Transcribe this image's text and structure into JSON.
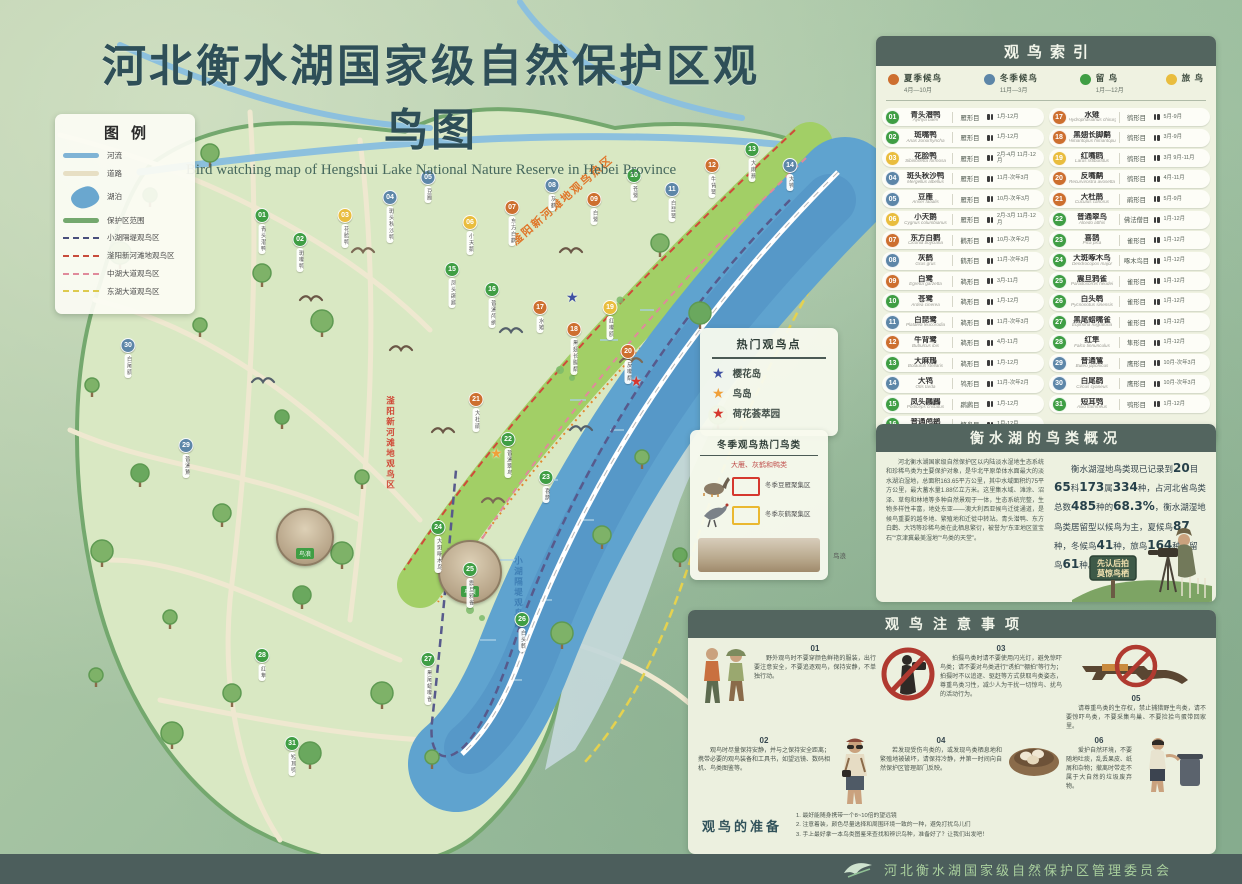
{
  "title": {
    "cn": "河北衡水湖国家级自然保护区观鸟图",
    "en": "Bird watching map of Hengshui Lake National Nature Reserve in Hebei Province"
  },
  "legend": {
    "title": "图例",
    "items": [
      {
        "label": "河流",
        "type": "line",
        "color": "#7fb3d5"
      },
      {
        "label": "道路",
        "type": "line",
        "color": "#e7dfc4"
      },
      {
        "label": "湖泊",
        "type": "blob",
        "color": "#6aa7cf"
      },
      {
        "label": "保护区范围",
        "type": "line",
        "color": "#74a86e"
      },
      {
        "label": "小湖隔堤观鸟区",
        "type": "dash",
        "color": "#4a4f7c"
      },
      {
        "label": "滏阳新河滩地观鸟区",
        "type": "dash",
        "color": "#c84b3c"
      },
      {
        "label": "中湖大道观鸟区",
        "type": "dash",
        "color": "#e08a9b"
      },
      {
        "label": "东湖大道观鸟区",
        "type": "dash",
        "color": "#ddca4e"
      }
    ]
  },
  "map": {
    "hot_zone_label": "滏阳新河滩地观鸟热区",
    "strip_label": "滏阳新河滩地观鸟区",
    "dike_label": "小湖隔堤观鸟区",
    "bird_wave_label": "鸟浪"
  },
  "hotspots": {
    "title": "热门观鸟点",
    "items": [
      {
        "label": "樱花岛",
        "color": "#3f51a3"
      },
      {
        "label": "鸟岛",
        "color": "#f0a03a"
      },
      {
        "label": "荷花荟萃园",
        "color": "#d5382e"
      }
    ]
  },
  "winter": {
    "title": "冬季观鸟热门鸟类",
    "subtitle": "大雁、灰鹤和鸭类",
    "zones": [
      {
        "icon": "goose",
        "swatch": "#d5382e",
        "label": "冬季豆雁聚集区"
      },
      {
        "icon": "crane",
        "swatch": "#eab830",
        "label": "冬季灰鹤聚集区"
      }
    ],
    "photo_label": "鸟浪"
  },
  "index": {
    "title": "观鸟索引",
    "seasons": [
      {
        "key": "summer",
        "label": "夏季候鸟",
        "months": "4月—10月",
        "color": "#cd6f2f"
      },
      {
        "key": "winter",
        "label": "冬季候鸟",
        "months": "11月—3月",
        "color": "#5d86a8"
      },
      {
        "key": "resident",
        "label": "留  鸟",
        "months": "1月—12月",
        "color": "#3f9e44"
      },
      {
        "key": "passage",
        "label": "旅  鸟",
        "months": "",
        "color": "#e9bd3e"
      }
    ],
    "items": [
      {
        "num": "01",
        "name": "青头潜鸭",
        "latin": "Aythya baeri",
        "order": "雁形目",
        "months": "1月-12月",
        "season": "resident"
      },
      {
        "num": "02",
        "name": "斑嘴鸭",
        "latin": "Anas zonorhyncha",
        "order": "雁形目",
        "months": "1月-12月",
        "season": "resident"
      },
      {
        "num": "03",
        "name": "花脸鸭",
        "latin": "Sibirionetta formosa",
        "order": "雁形目",
        "months": "2月-4月 11月-12月",
        "season": "passage"
      },
      {
        "num": "04",
        "name": "斑头秋沙鸭",
        "latin": "Mergellus albellus",
        "order": "雁形目",
        "months": "11月-次年3月",
        "season": "winter"
      },
      {
        "num": "05",
        "name": "豆雁",
        "latin": "Anser fabalis",
        "order": "雁形目",
        "months": "10月-次年3月",
        "season": "winter"
      },
      {
        "num": "06",
        "name": "小天鹅",
        "latin": "Cygnus columbianus",
        "order": "雁形目",
        "months": "2月-3月 11月-12月",
        "season": "passage"
      },
      {
        "num": "07",
        "name": "东方白鹳",
        "latin": "Ciconia boyciana",
        "order": "鹳形目",
        "months": "10月-次年2月",
        "season": "summer"
      },
      {
        "num": "08",
        "name": "灰鹤",
        "latin": "Grus grus",
        "order": "鹤形目",
        "months": "11月-次年3月",
        "season": "winter"
      },
      {
        "num": "09",
        "name": "白鹭",
        "latin": "Egretta garzetta",
        "order": "鹈形目",
        "months": "3月-11月",
        "season": "summer"
      },
      {
        "num": "10",
        "name": "苍鹭",
        "latin": "Ardea cinerea",
        "order": "鹈形目",
        "months": "1月-12月",
        "season": "resident"
      },
      {
        "num": "11",
        "name": "白琵鹭",
        "latin": "Platalea leucorodia",
        "order": "鹈形目",
        "months": "11月-次年3月",
        "season": "winter"
      },
      {
        "num": "12",
        "name": "牛背鹭",
        "latin": "Bubulcus ibis",
        "order": "鹈形目",
        "months": "4月-11月",
        "season": "summer"
      },
      {
        "num": "13",
        "name": "大麻鳽",
        "latin": "Botaurus stellaris",
        "order": "鹈形目",
        "months": "1月-12月",
        "season": "resident"
      },
      {
        "num": "14",
        "name": "大鸨",
        "latin": "Otis tarda",
        "order": "鸨形目",
        "months": "11月-次年2月",
        "season": "winter"
      },
      {
        "num": "15",
        "name": "凤头鸊鷉",
        "latin": "Podiceps cristatus",
        "order": "䴙䴘目",
        "months": "1月-12月",
        "season": "resident"
      },
      {
        "num": "16",
        "name": "普通鸬鹚",
        "latin": "Phalacrocorax carbo",
        "order": "鲣鸟目",
        "months": "1月-12月",
        "season": "resident"
      },
      {
        "num": "17",
        "name": "水雉",
        "latin": "Hydrophasianus chirurgus",
        "order": "鸻形目",
        "months": "5月-9月",
        "season": "summer"
      },
      {
        "num": "18",
        "name": "黑翅长脚鹬",
        "latin": "Himantopus himantopus",
        "order": "鸻形目",
        "months": "3月-9月",
        "season": "summer"
      },
      {
        "num": "19",
        "name": "红嘴鸥",
        "latin": "Larus ridibundus",
        "order": "鸻形目",
        "months": "3月 9月-11月",
        "season": "passage"
      },
      {
        "num": "20",
        "name": "反嘴鹬",
        "latin": "Recurvirostra avosetta",
        "order": "鸻形目",
        "months": "4月-11月",
        "season": "summer"
      },
      {
        "num": "21",
        "name": "大杜鹃",
        "latin": "Cuculus canorus",
        "order": "鹃形目",
        "months": "5月-9月",
        "season": "summer"
      },
      {
        "num": "22",
        "name": "普通翠鸟",
        "latin": "Alcedo atthis",
        "order": "佛法僧目",
        "months": "1月-12月",
        "season": "resident"
      },
      {
        "num": "23",
        "name": "喜鹊",
        "latin": "Pica pica",
        "order": "雀形目",
        "months": "1月-12月",
        "season": "resident"
      },
      {
        "num": "24",
        "name": "大斑啄木鸟",
        "latin": "Dendrocopos major",
        "order": "啄木鸟目",
        "months": "1月-12月",
        "season": "resident"
      },
      {
        "num": "25",
        "name": "震旦鸦雀",
        "latin": "Paradoxornis heudei",
        "order": "雀形目",
        "months": "1月-12月",
        "season": "resident"
      },
      {
        "num": "26",
        "name": "白头鹎",
        "latin": "Pycnonotus sinensis",
        "order": "雀形目",
        "months": "1月-12月",
        "season": "resident"
      },
      {
        "num": "27",
        "name": "黑尾蜡嘴雀",
        "latin": "Eophona migratoria",
        "order": "雀形目",
        "months": "1月-12月",
        "season": "resident"
      },
      {
        "num": "28",
        "name": "红隼",
        "latin": "Falco tinnunculus",
        "order": "隼形目",
        "months": "1月-12月",
        "season": "resident"
      },
      {
        "num": "29",
        "name": "普通鵟",
        "latin": "Buteo japonicus",
        "order": "鹰形目",
        "months": "10月-次年3月",
        "season": "winter"
      },
      {
        "num": "30",
        "name": "白尾鹞",
        "latin": "Circus cyaneus",
        "order": "鹰形目",
        "months": "10月-次年3月",
        "season": "winter"
      },
      {
        "num": "31",
        "name": "短耳鸮",
        "latin": "Asio flammeus",
        "order": "鸮形目",
        "months": "1月-12月",
        "season": "resident"
      }
    ]
  },
  "overview": {
    "title": "衡水湖的鸟类概况",
    "paragraph_left": "河北衡水湖国家级自然保护区以内陆淡水湿地生态系统和珍稀鸟类为主要保护对象，是华北平原单体水面最大的淡水湖泊湿地，总面积163.65平方公里，其中水域面积约75平方公里，最大蓄水量1.88亿立方米。这里集水域、滩涂、沼泽、草甸和林地等多种自然景观于一体，生态系统完整，生物多样性丰富，地处东亚——澳大利西亚候鸟迁徙通道，是候鸟重要的越冬地、繁殖地和迁徙中转站。青头潜鸭、东方白鹳、大鸨等珍稀鸟类在此栖息繁衍，被誉为“东亚地区蓝宝石”“京津冀最美湿地”“鸟类的天堂”。",
    "stats_segments": [
      {
        "t": "衡水湖湿地鸟类现已记录到"
      },
      {
        "t": "20",
        "b": true
      },
      {
        "t": "目"
      },
      {
        "t": "65",
        "b": true
      },
      {
        "t": "科"
      },
      {
        "t": "173",
        "b": true
      },
      {
        "t": "属"
      },
      {
        "t": "334",
        "b": true
      },
      {
        "t": "种，占河北省鸟类总数"
      },
      {
        "t": "485",
        "b": true
      },
      {
        "t": "种的"
      },
      {
        "t": "68.3%",
        "b": true
      },
      {
        "t": "，衡水湖湿地鸟类居留型以候鸟为主，夏候鸟"
      },
      {
        "t": "87",
        "b": true
      },
      {
        "t": "种，冬候鸟"
      },
      {
        "t": "41",
        "b": true
      },
      {
        "t": "种，旅鸟"
      },
      {
        "t": "164",
        "b": true
      },
      {
        "t": "种，留鸟"
      },
      {
        "t": "61",
        "b": true
      },
      {
        "t": "种。"
      }
    ],
    "sign_line1": "先认后拍",
    "sign_line2": "莫惊鸟栖"
  },
  "notes": {
    "title": "观鸟注意事项",
    "items": [
      {
        "num": "01",
        "text": "野外观鸟时不要穿颜色鲜艳的服装，出行要注意安全，不要追逐观鸟，保持安静，不单独行动。"
      },
      {
        "num": "02",
        "text": "观鸟时尽量保持安静，并与之保持安全距离；携带必要的观鸟装备和工具书，如望远镜、数码相机、鸟类图鉴等。"
      },
      {
        "num": "03",
        "text": "拍摄鸟类时请不要使用闪光灯，避免惊吓鸟类；请不要对鸟类进行“诱拍”“棚拍”等行为；拍摄时不以追逐、驱赶等方式获取鸟类姿态，尊重鸟类习性，减少人为干扰一切惊鸟、扰鸟的活动行为。"
      },
      {
        "num": "04",
        "text": "若发现受伤鸟类的，或发现鸟类栖息地和繁殖地被破坏，请保持冷静，并第一时间向自然保护区管理部门反映。"
      },
      {
        "num": "05",
        "text": "请尊重鸟类的生存权，禁止捕猎野生鸟类，请不要惊吓鸟类，不要采集鸟巢、不要捡拾鸟蛋带回家里。"
      },
      {
        "num": "06",
        "text": "爱护自然环境，不要随地吐痰，乱丢果皮、纸屑和杂物；撤离时带走不属于大自然的垃圾废弃物。"
      }
    ],
    "prep_title": "观鸟的准备",
    "prep": [
      "1. 最好能随身携带一个8~10倍的望远镜",
      "2. 注意着装，颜色尽量选择和周围环境一致的一种，避免打扰鸟儿们",
      "3. 手上最好拿一本鸟类图鉴来查找和辨识鸟种，准备好了？让我们出发吧！"
    ]
  },
  "footer": {
    "org": "河北衡水湖国家级自然保护区管理委员会"
  }
}
